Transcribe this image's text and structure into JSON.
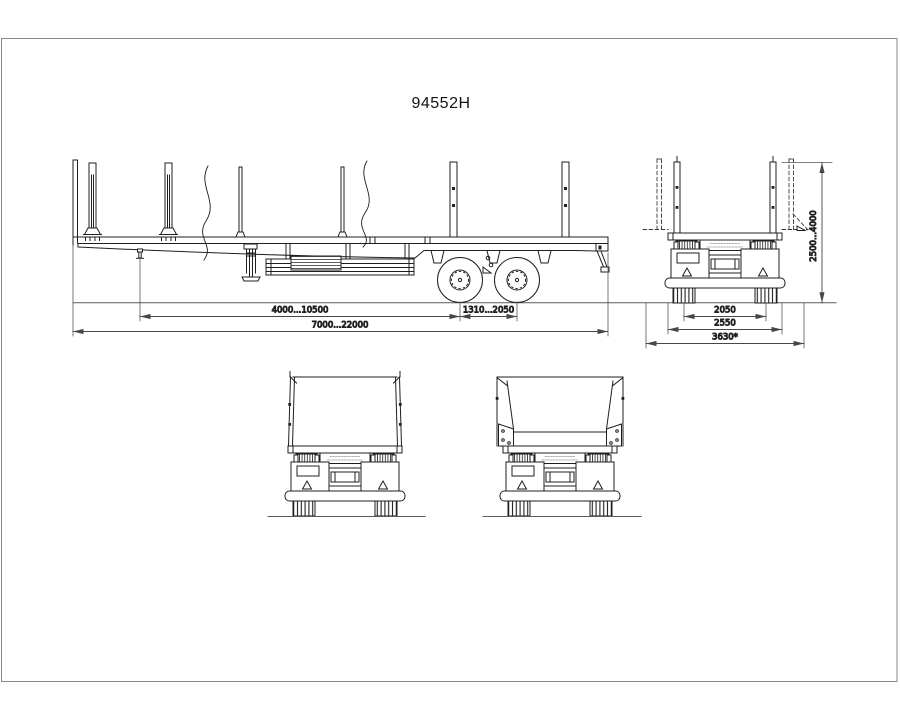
{
  "sheet": {
    "title": "94552H"
  },
  "dimensions": {
    "side": {
      "kingpin_to_first_axle": "4000...10500",
      "axle_base": "1310...2050",
      "overall_length": "7000...22000"
    },
    "rear": {
      "stake_height": "2500...4000",
      "track_width": "2050",
      "frame_width": "2550",
      "max_width": "3630*"
    }
  }
}
